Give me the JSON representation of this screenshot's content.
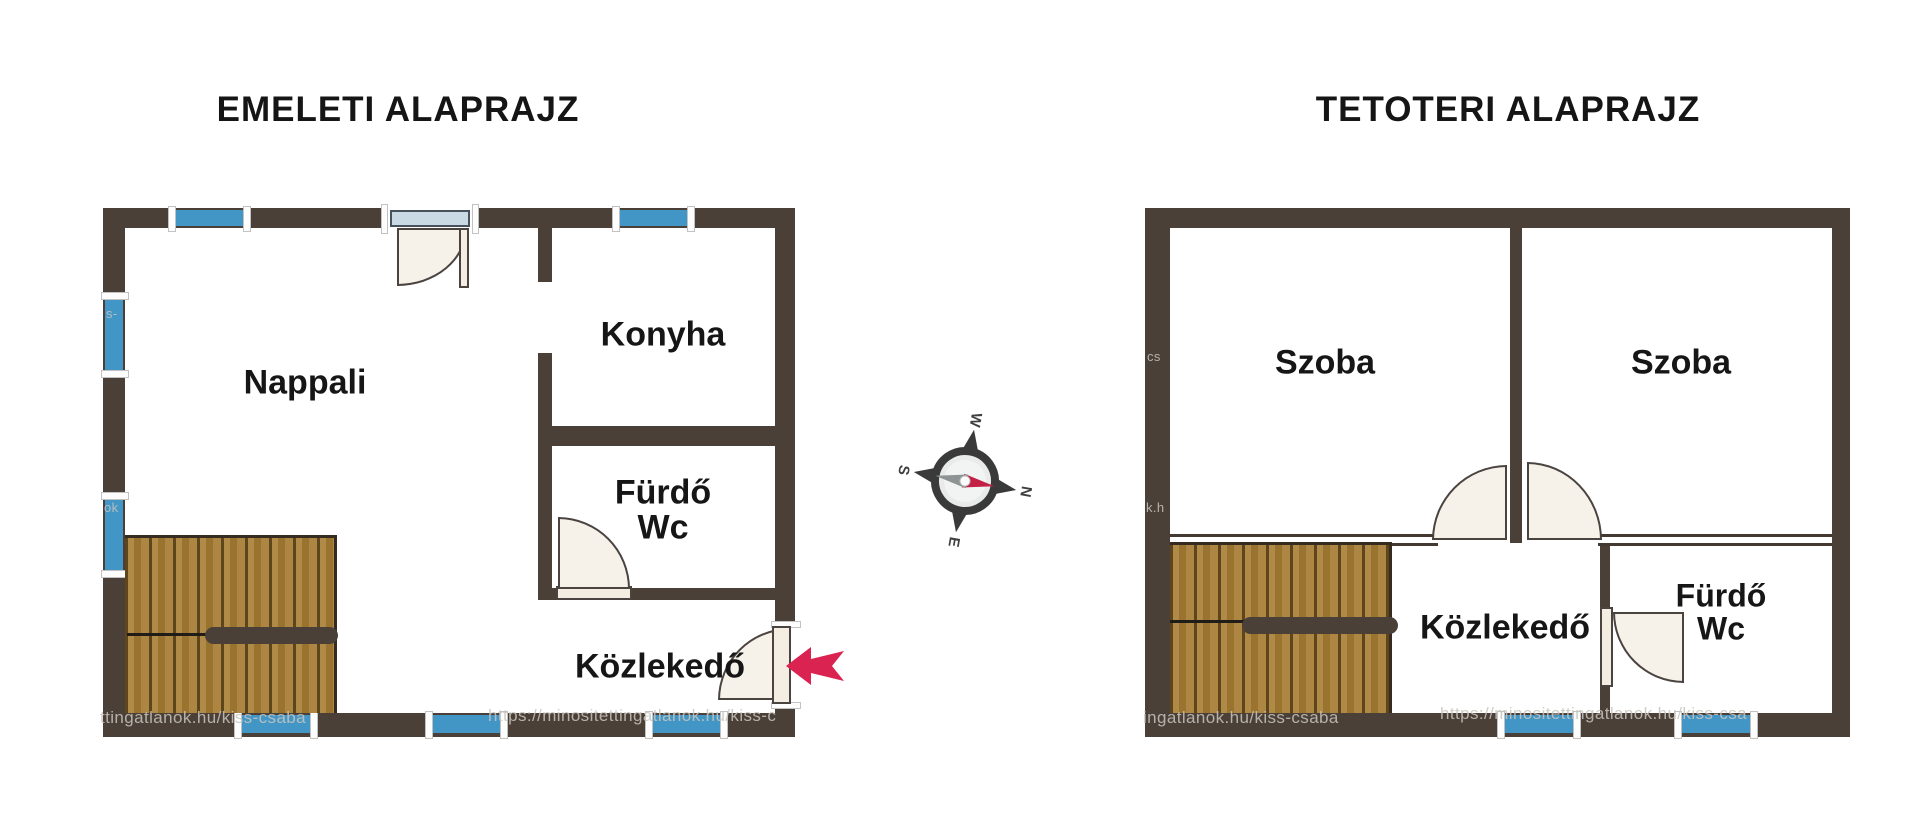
{
  "titles": {
    "left": "EMELETI ALAPRAJZ",
    "right": "TETOTERI ALAPRAJZ"
  },
  "floor1": {
    "rooms": {
      "nappali": "Nappali",
      "konyha": "Konyha",
      "furdo_line1": "Fürdő",
      "furdo_line2": "Wc",
      "kozlekedo": "Közlekedő"
    }
  },
  "floor2": {
    "rooms": {
      "szoba_left": "Szoba",
      "szoba_right": "Szoba",
      "kozlekedo": "Közlekedő",
      "furdo_line1": "Fürdő",
      "furdo_line2": "Wc"
    }
  },
  "compass": {
    "n": "N",
    "e": "E",
    "s": "S",
    "w": "W"
  },
  "watermarks": [
    {
      "text": "https://minositettingatlanok.hu/kiss-c"
    },
    {
      "text": "ttingatlanok.hu/kiss-csaba"
    },
    {
      "text": "ingatlanok.hu/kiss-csaba"
    },
    {
      "text": "https://minositettingatlanok.hu/kiss-csa"
    },
    {
      "text": "ok"
    },
    {
      "text": "k.h"
    },
    {
      "text": "cs"
    },
    {
      "text": "s-"
    }
  ],
  "colors": {
    "wall": "#4b4038",
    "thin_wall": "#433931",
    "window_blue": "#4296c6",
    "door_fill": "#f7f2e9",
    "door_glass": "#c9dae5",
    "stair_wood": "#ad8643",
    "arrow_red": "#da2350",
    "label_text": "#161616"
  }
}
